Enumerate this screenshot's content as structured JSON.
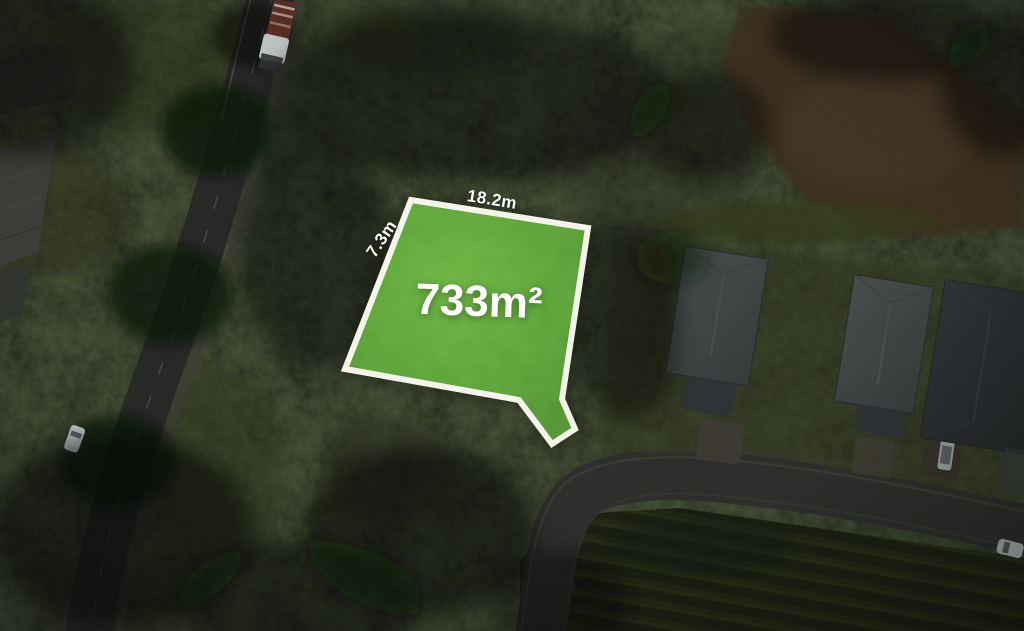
{
  "page": {
    "width_px": 1024,
    "height_px": 631
  },
  "overlay": {
    "area_label": "733m²",
    "top_dimension_label": "18.2m",
    "left_dimension_label": "7.3m",
    "highlight_fill": "#58a132",
    "border_color": "#f4f4ea",
    "label_color": "#ffffff"
  },
  "scene": {
    "type": "darkened-aerial-photograph",
    "features": [
      "highlighted-lot",
      "main-road-left",
      "side-street-bottom-right",
      "house-roofs-right",
      "dirt-field-top-right",
      "industrial-roofs-left",
      "truck-on-road",
      "white-cars",
      "tree-canopy"
    ]
  }
}
